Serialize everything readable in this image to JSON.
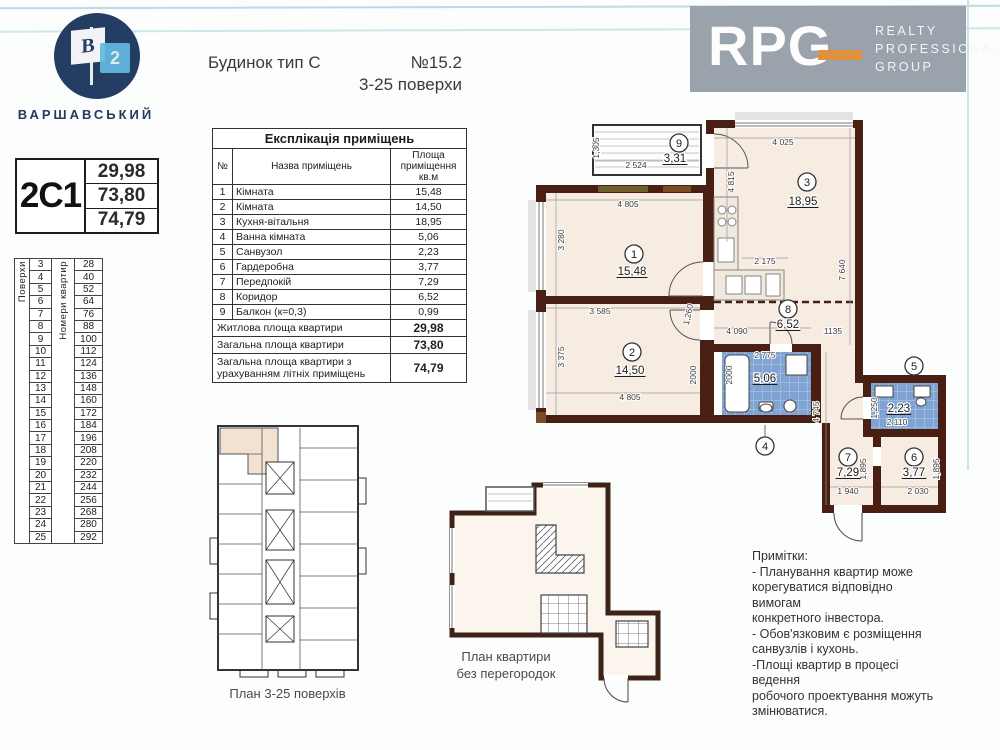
{
  "logo": {
    "flag_letter": "B",
    "flag_number": "2",
    "name": "ВАРШАВСЬКИЙ"
  },
  "header": {
    "building_type": "Будинок тип С",
    "number": "№15.2",
    "floors_range": "3-25 поверхи"
  },
  "rpg": {
    "letters": "RPG",
    "line1": "REALTY",
    "line2": "PROFESSIONAL",
    "line3": "GROUP",
    "bg": "#9aa2ac",
    "accent": "#e0913f"
  },
  "apartment_card": {
    "code": "2С1",
    "values": [
      "29,98",
      "73,80",
      "74,79"
    ]
  },
  "floors_table": {
    "col1_label": "Поверхи",
    "col2_label": "Номери квартир",
    "floors": [
      3,
      4,
      5,
      6,
      7,
      8,
      9,
      10,
      11,
      12,
      13,
      14,
      15,
      16,
      17,
      18,
      19,
      20,
      21,
      22,
      23,
      24,
      25
    ],
    "apartments": [
      28,
      40,
      52,
      64,
      76,
      88,
      100,
      112,
      124,
      136,
      148,
      160,
      172,
      184,
      196,
      208,
      220,
      232,
      244,
      256,
      268,
      280,
      292
    ]
  },
  "explication": {
    "title": "Експлікація приміщень",
    "headers": [
      "№",
      "Назва приміщень",
      "Площа приміщення кв.м"
    ],
    "rows": [
      [
        "1",
        "Кімната",
        "15,48"
      ],
      [
        "2",
        "Кімната",
        "14,50"
      ],
      [
        "3",
        "Кухня-вітальня",
        "18,95"
      ],
      [
        "4",
        "Ванна кімната",
        "5,06"
      ],
      [
        "5",
        "Санвузол",
        "2,23"
      ],
      [
        "6",
        "Гардеробна",
        "3,77"
      ],
      [
        "7",
        "Передпокій",
        "7,29"
      ],
      [
        "8",
        "Коридор",
        "6,52"
      ],
      [
        "9",
        "Балкон (к=0,3)",
        "0,99"
      ]
    ],
    "totals": [
      [
        "Житлова площа квартири",
        "29,98"
      ],
      [
        "Загальна площа квартири",
        "73,80"
      ],
      [
        "Загальна площа квартири з урахуванням літніх приміщень",
        "74,79"
      ]
    ]
  },
  "plan": {
    "wall_color": "#4a1f13",
    "room_fill": "#f7ece2",
    "tile_color": "#7fa4d4",
    "rooms": [
      {
        "n": "1",
        "a": "15,48",
        "cx": 106,
        "cy": 142,
        "ax": 104,
        "ay": 163
      },
      {
        "n": "2",
        "a": "14,50",
        "cx": 104,
        "cy": 240,
        "ax": 102,
        "ay": 262
      },
      {
        "n": "3",
        "a": "18,95",
        "cx": 279,
        "cy": 70,
        "ax": 275,
        "ay": 93
      },
      {
        "n": "9",
        "a": "3,31",
        "cx": 151,
        "cy": 31,
        "ax": 147,
        "ay": 50
      },
      {
        "n": "8",
        "a": "6,52",
        "cx": 260,
        "cy": 197,
        "ax": 260,
        "ay": 216
      },
      {
        "n": "4",
        "a": "5,06",
        "cx": 237,
        "cy": 334,
        "ax": 237,
        "ay": 270,
        "stem": [
          237,
          325,
          237,
          313
        ]
      },
      {
        "n": "5",
        "a": "2,23",
        "cx": 386,
        "cy": 254,
        "ax": 371,
        "ay": 300
      },
      {
        "n": "7",
        "a": "7,29",
        "cx": 320,
        "cy": 345,
        "ax": 320,
        "ay": 364
      },
      {
        "n": "6",
        "a": "3,77",
        "cx": 386,
        "cy": 345,
        "ax": 386,
        "ay": 364
      }
    ],
    "dims": [
      {
        "t": "4 805",
        "x": 100,
        "y": 95
      },
      {
        "t": "3 280",
        "x": 36,
        "y": 128,
        "r": -90
      },
      {
        "t": "3 585",
        "x": 72,
        "y": 202
      },
      {
        "t": "3 375",
        "x": 36,
        "y": 245,
        "r": -90
      },
      {
        "t": "4 805",
        "x": 102,
        "y": 288
      },
      {
        "t": "2000",
        "x": 168,
        "y": 263,
        "r": -90
      },
      {
        "t": "4 025",
        "x": 255,
        "y": 33
      },
      {
        "t": "4 815",
        "x": 206,
        "y": 70,
        "r": -90
      },
      {
        "t": "7 640",
        "x": 317,
        "y": 158,
        "r": -90
      },
      {
        "t": "2 175",
        "x": 237,
        "y": 152
      },
      {
        "t": "1,305",
        "x": 71,
        "y": 36,
        "r": -90
      },
      {
        "t": "2 524",
        "x": 108,
        "y": 56
      },
      {
        "t": "4 090",
        "x": 209,
        "y": 222
      },
      {
        "t": "1135",
        "x": 305,
        "y": 222
      },
      {
        "t": "1,260",
        "x": 163,
        "y": 203,
        "r": -78
      },
      {
        "t": "2 775",
        "x": 237,
        "y": 246
      },
      {
        "t": "2000",
        "x": 204,
        "y": 263,
        "r": -90
      },
      {
        "t": "2 110",
        "x": 369,
        "y": 313
      },
      {
        "t": "1,250",
        "x": 349,
        "y": 296,
        "r": -90
      },
      {
        "t": "1 940",
        "x": 320,
        "y": 382
      },
      {
        "t": "1,895",
        "x": 338,
        "y": 357,
        "r": -90
      },
      {
        "t": "2 030",
        "x": 390,
        "y": 382
      },
      {
        "t": "1,895",
        "x": 411,
        "y": 357,
        "r": -90
      },
      {
        "t": "4 745",
        "x": 291,
        "y": 300,
        "r": -90
      }
    ]
  },
  "key_plan": {
    "caption": "План 3-25 поверхів"
  },
  "open_plan": {
    "caption_line1": "План квартири",
    "caption_line2": "без перегородок"
  },
  "notes": {
    "lines": [
      "Примітки:",
      "- Планування квартир може",
      "корегуватися  відповідно вимогам",
      "конкретного інвестора.",
      "- Обов'язковим є розміщення",
      "санвузлів і кухонь.",
      "-Площі квартир в процесі ведення",
      "робочого проектування можуть",
      "змінюватися."
    ]
  }
}
